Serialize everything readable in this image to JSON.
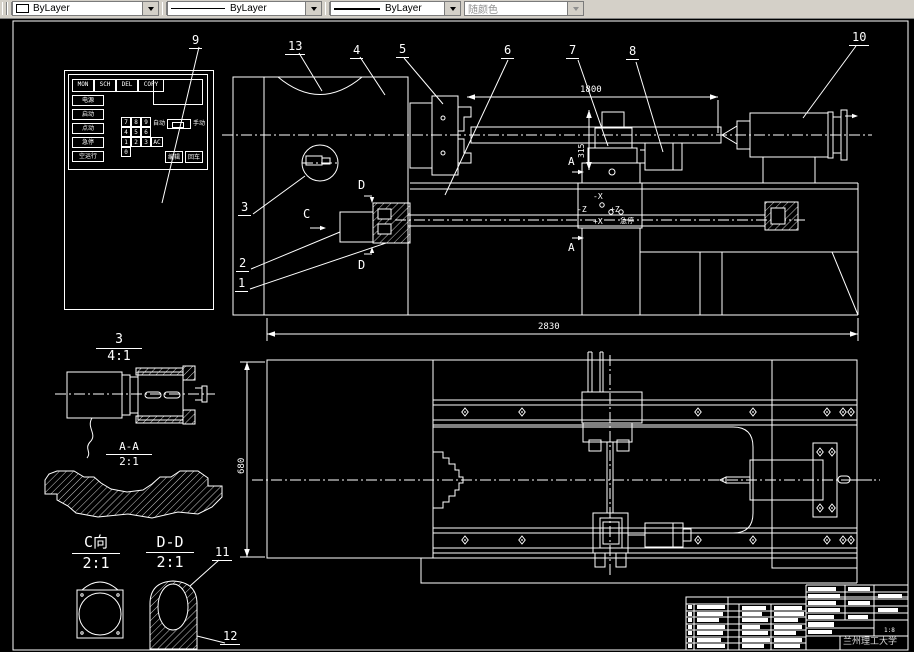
{
  "toolbar": {
    "combos": [
      {
        "value": "ByLayer",
        "type": "color"
      },
      {
        "value": "ByLayer",
        "type": "linetype"
      },
      {
        "value": "ByLayer",
        "type": "lineweight"
      },
      {
        "value": "随颜色",
        "type": "plotstyle"
      }
    ]
  },
  "canvas": {
    "callouts": {
      "c1": "1",
      "c2": "2",
      "c3": "3",
      "c4": "4",
      "c5": "5",
      "c6": "6",
      "c7": "7",
      "c8": "8",
      "c9": "9",
      "c10": "10",
      "c11": "11",
      "c12": "12",
      "c13": "13"
    },
    "dims": {
      "d1800": "1800",
      "d2830": "2830",
      "d315": "315",
      "d680": "680"
    },
    "details": {
      "d3n": "3",
      "d3s": "4:1",
      "aan": "A-A",
      "aas": "2:1",
      "cvn": "C向",
      "cvs": "2:1",
      "ddn": "D-D",
      "dds": "2:1"
    },
    "marks": {
      "a_top": "A",
      "a_bottom": "A",
      "c": "C",
      "d_top": "D",
      "d_bottom": "D"
    },
    "axes": {
      "xm": "-X",
      "zm": "-Z",
      "zp": "+Z",
      "xp": "+X",
      "estop": "急停"
    },
    "panel": {
      "tabs": [
        "MON",
        "SCH",
        "DEL",
        "COPY"
      ],
      "buttons": [
        "电源",
        "启动",
        "点动",
        "急停",
        "空运行"
      ],
      "keys": [
        "7",
        "8",
        "9",
        "4",
        "5",
        "6",
        "1",
        "2",
        "3",
        "AC",
        "0"
      ],
      "auto": "自动",
      "manual": "手动",
      "edit": "编辑",
      "enter": "回车"
    },
    "titleblock": {
      "school": "兰州理工大学",
      "scale": "1:8"
    }
  }
}
